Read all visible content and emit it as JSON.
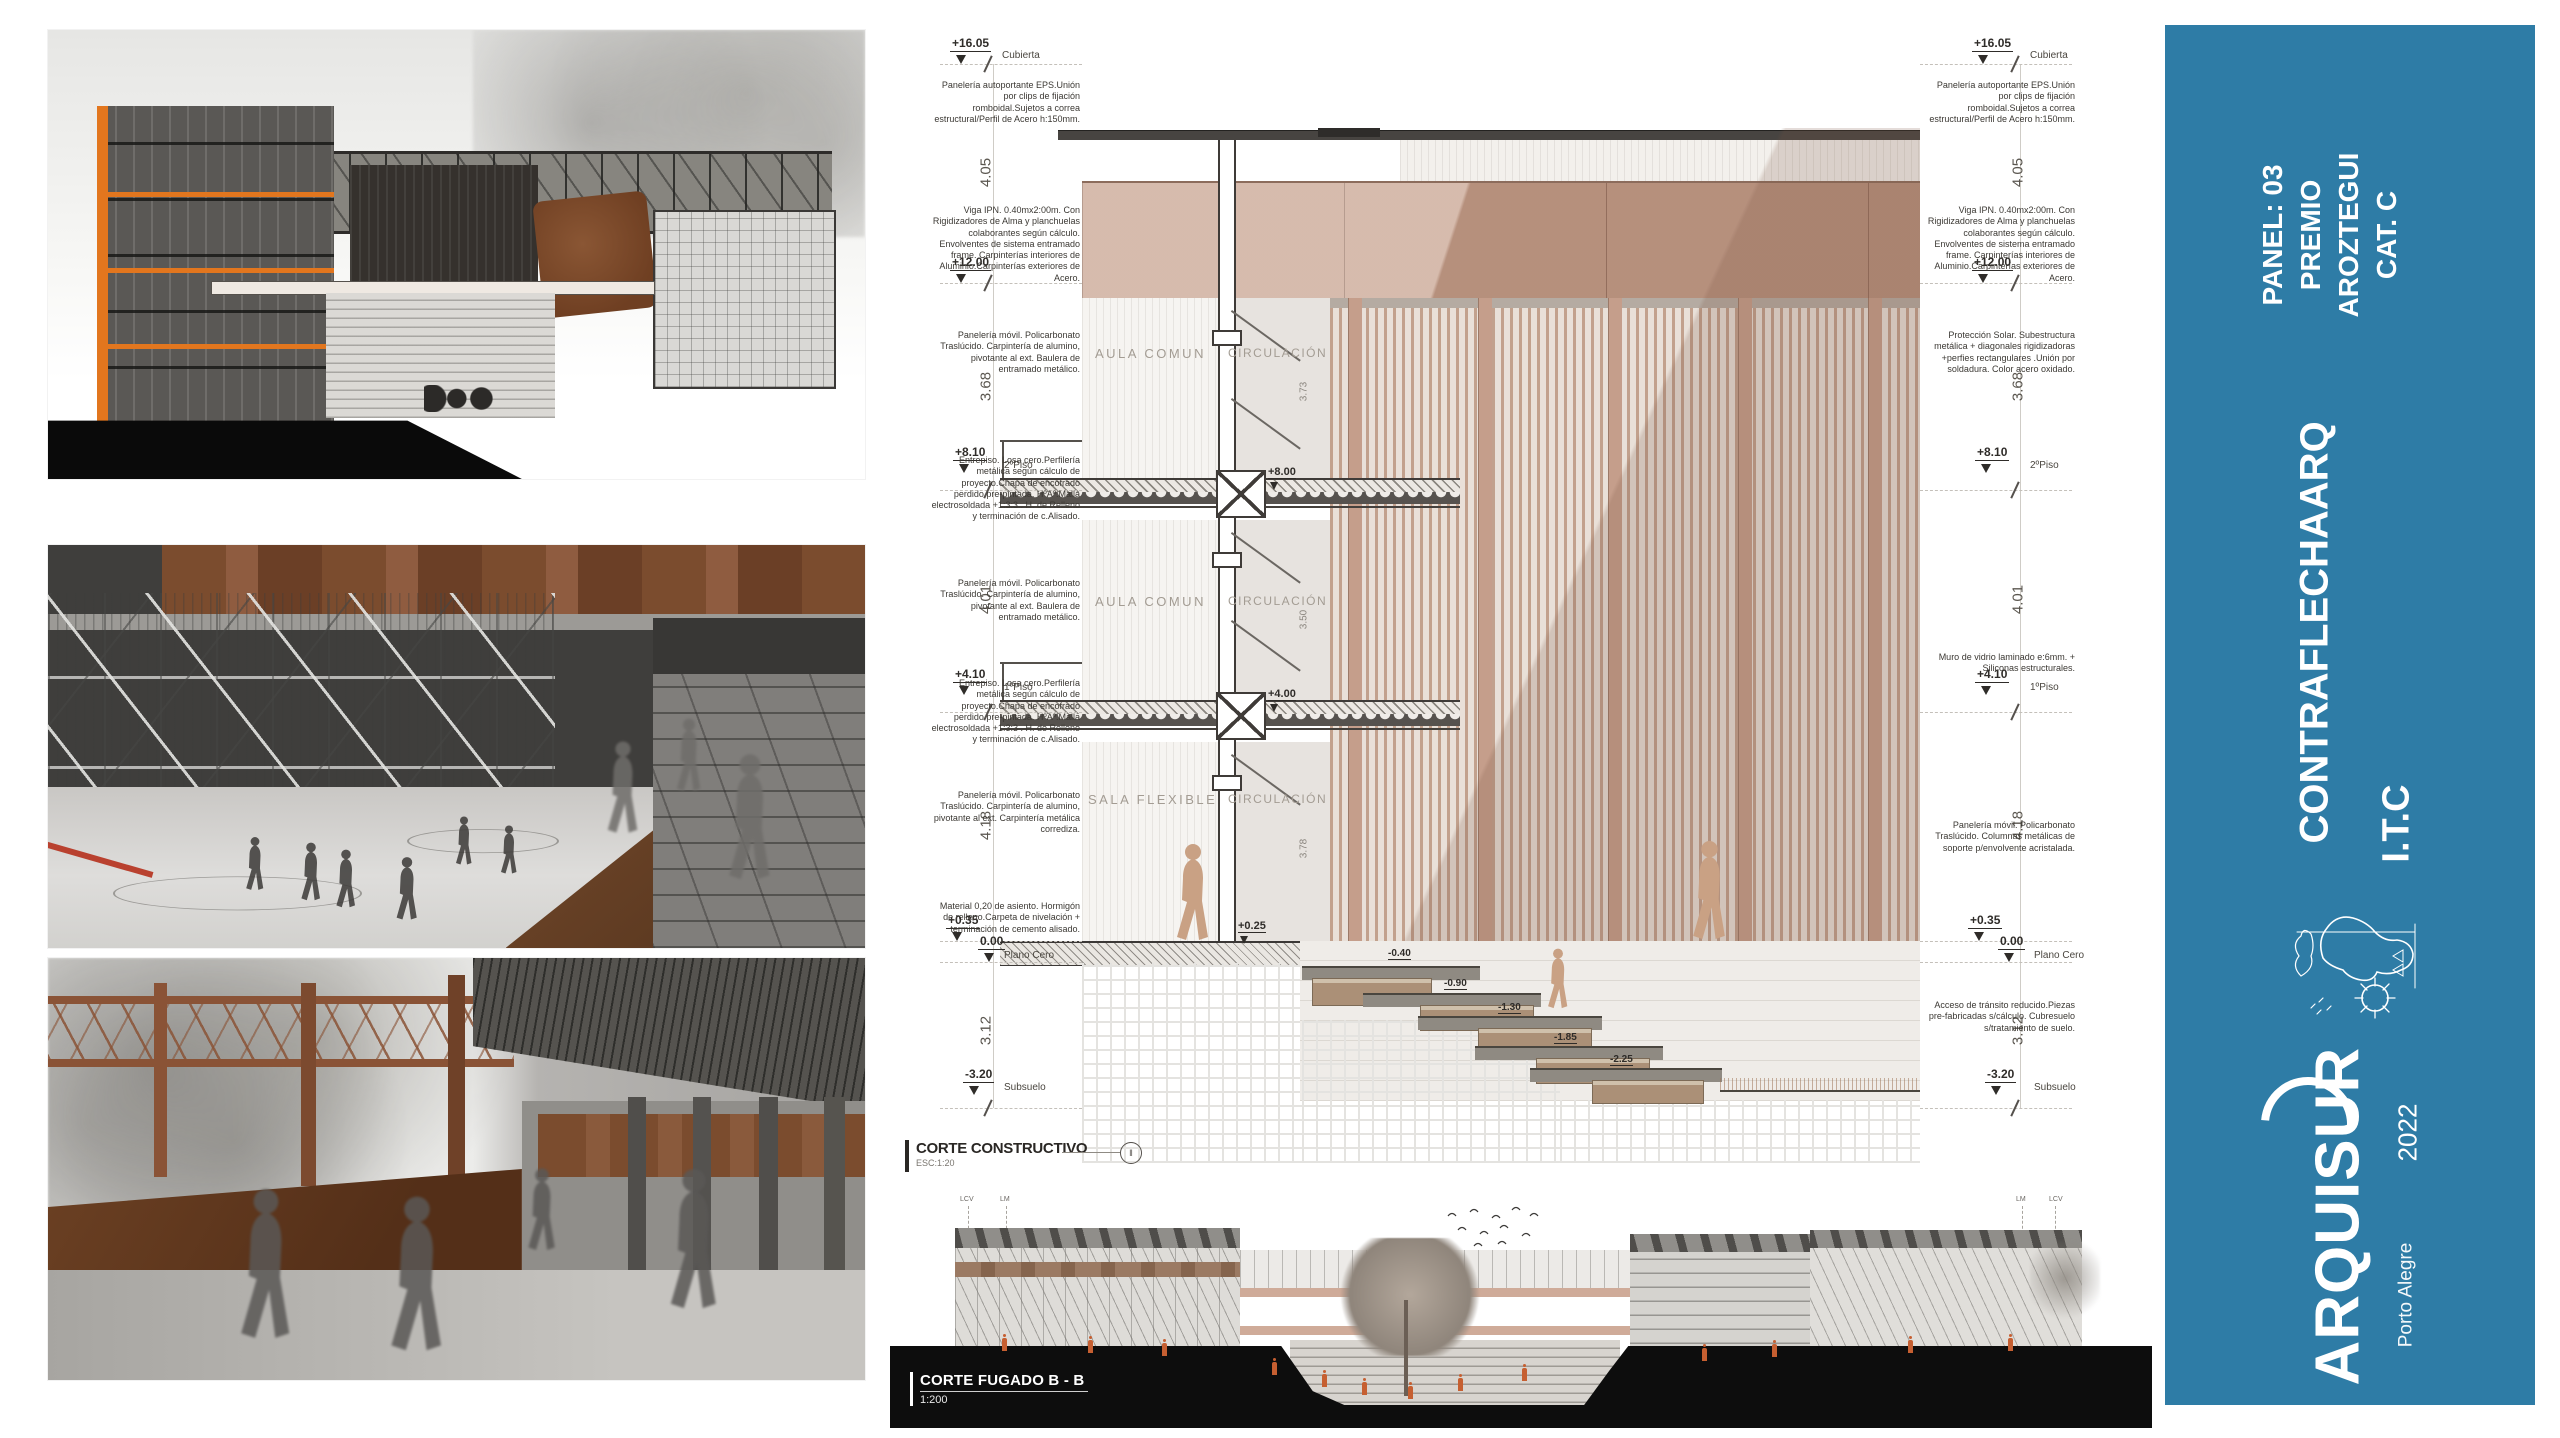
{
  "banner": {
    "bg_color": "#2e7ca6",
    "panel_lines": [
      "PANEL: 03",
      "PREMIO",
      "AROZTEGUI",
      "CAT. C"
    ],
    "team_name": "CONTRAFLECHAARQ",
    "team_sub": "I.T.C",
    "logo_text": "ARQUISUR",
    "logo_year": "2022",
    "logo_city": "Porto Alegre"
  },
  "section": {
    "title": "CORTE CONSTRUCTIVO",
    "scale_label": "ESC:1:20",
    "rooms": {
      "aula_comun": "AULA COMUN",
      "circulacion": "CIRCULACIÓN",
      "sala_flexible": "SALA FLEXIBLE"
    },
    "levels": [
      {
        "value": "+16.05",
        "name": "Cubierta"
      },
      {
        "value": "+12.00",
        "name": ""
      },
      {
        "value": "+8.10",
        "name": "2ºPiso"
      },
      {
        "value": "+4.10",
        "name": "1ºPiso"
      },
      {
        "value": "+0.35",
        "name": ""
      },
      {
        "value": "0.00",
        "name": "Plano Cero"
      },
      {
        "value": "-3.20",
        "name": "Subsuelo"
      }
    ],
    "dims": [
      "4.05",
      "3.68",
      "4.01",
      "4.18",
      "3.12"
    ],
    "interior_dims": [
      "3.73",
      "3.50",
      "3.78"
    ],
    "inner_levels": [
      "+8.00",
      "+4.00",
      "+0.25"
    ],
    "step_levels": [
      "-0.40",
      "-0.90",
      "-1.30",
      "-1.85",
      "-2.25"
    ],
    "annotations": {
      "paneleria_eps": "Panelería autoportante EPS.Unión por clips de fijación romboidal.Sujetos a correa estructural/Perfil de Acero h:150mm.",
      "viga_ipn": "Viga IPN. 0.40mx2:00m. Con Rigidizadores de Alma y planchuelas colaborantes según cálculo. Envolventes de sistema entramado frame. Carpinterías interiores de Aluminio.Carpinterías exteriores de Acero.",
      "paneleria_movil_baulera": "Panelería móvil. Policarbonato Traslúcido. Carpintería de alumino, pivotante al ext. Baulera de entramado metálico.",
      "entrepiso": "Entrepiso. Losa cero.Perfilería metálica según cálculo de proyecto.Chapa de encofrado perdido pre-pintada. HºAº.Malla electrosoldada +1:3:3 . H. de Relleno y terminación de c.Alisado.",
      "paneleria_movil_corrediza": "Panelería móvil. Policarbonato Traslúcido. Carpintería de alumino, pivotante al ext. Carpintería metálica corrediza.",
      "material_asiento": "Material 0,20 de asiento. Hormigón de relleno.Carpeta de nivelación + terminación de cemento alisado.",
      "proteccion_solar": "Protección Solar. Subestructura metálica + diagonales rigidizadoras +perfies rectangulares .Unión por soldadura. Color acero oxidado.",
      "muro_vidrio": "Muro de vidrio laminado e:6mm. + Siliconas estructurales.",
      "paneleria_columnas": "Panelería móvil. Policarbonato Traslúcido. Columnas metálicas de soporte p/envolvente acristalada.",
      "acceso_transito": "Acceso de tránsito reducido.Piezas pre-fabricadas s/cálculo. Cubresuelo s/tratamiento de suelo."
    }
  },
  "fugado": {
    "title": "CORTE FUGADO B - B",
    "scale_label": "1:200",
    "marks": [
      "LCV",
      "LM"
    ]
  }
}
